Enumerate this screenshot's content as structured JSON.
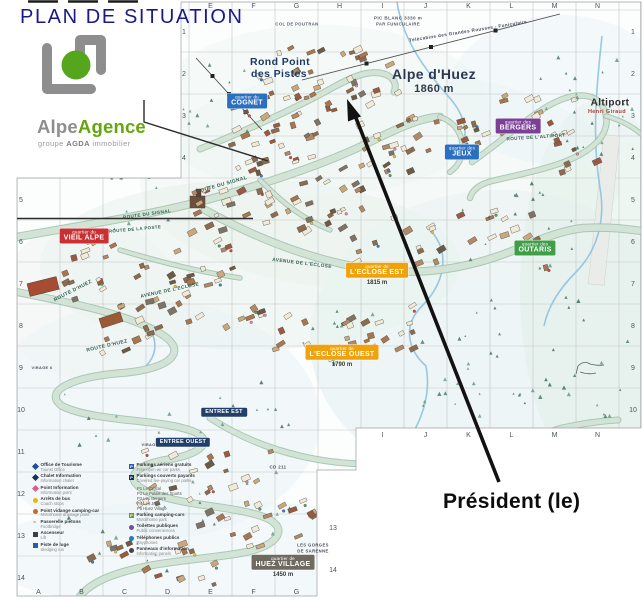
{
  "page": {
    "title": "PLAN DE SITUATION"
  },
  "logo": {
    "name_gray": "Alpe",
    "name_green": "Agence",
    "tagline": {
      "prefix": "groupe",
      "brand": "AGDA",
      "suffix": "immobilier"
    },
    "colors": {
      "gray": "#8e8e8e",
      "green": "#63a70f",
      "circle_green": "#55a51d"
    }
  },
  "annotation": {
    "president_label": "Président (le)"
  },
  "grid": {
    "top_letters": [
      "E",
      "F",
      "G",
      "H",
      "I",
      "J",
      "K",
      "L",
      "M",
      "N"
    ],
    "bottom_letters": [
      "A",
      "B",
      "C",
      "D",
      "E",
      "F",
      "G"
    ],
    "bottom_right_letters": [
      "I",
      "J",
      "K",
      "L",
      "M",
      "N"
    ],
    "left_numbers": [
      "1",
      "2",
      "3",
      "4",
      "5",
      "6",
      "7",
      "8",
      "9",
      "10",
      "11",
      "12",
      "13",
      "14"
    ],
    "right_numbers": [
      "1",
      "2",
      "3",
      "4",
      "5",
      "6",
      "7",
      "8",
      "9",
      "10"
    ],
    "inner_right_numbers": [
      "13",
      "14"
    ]
  },
  "districts": [
    {
      "key": "cognet",
      "prefix": "quartier du",
      "name": "COGNET",
      "x": 247,
      "y": 101,
      "bg": "#2a6fc0"
    },
    {
      "key": "jeux",
      "prefix": "quartier des",
      "name": "JEUX",
      "x": 462,
      "y": 152,
      "bg": "#2a6fc0"
    },
    {
      "key": "bergers",
      "prefix": "quartier des",
      "name": "BERGERS",
      "x": 518,
      "y": 126,
      "bg": "#7b3f97"
    },
    {
      "key": "vieil-alpe",
      "prefix": "quartier du",
      "name": "VIEIL ALPE",
      "x": 84,
      "y": 236,
      "bg": "#c92f33"
    },
    {
      "key": "outaris",
      "prefix": "quartier des",
      "name": "OUTARIS",
      "x": 535,
      "y": 248,
      "bg": "#3f9f47"
    },
    {
      "key": "eclose-est",
      "prefix": "quartier de",
      "name": "L'ECLOSE EST",
      "x": 377,
      "y": 274,
      "bg": "#efa20c",
      "alt": "1815 m"
    },
    {
      "key": "eclose-ouest",
      "prefix": "quartier de",
      "name": "L'ECLOSE OUEST",
      "x": 342,
      "y": 356,
      "bg": "#efa20c",
      "alt": "1790 m"
    },
    {
      "key": "huez-village",
      "prefix": "quartier de",
      "name": "HUEZ VILLAGE",
      "x": 283,
      "y": 566,
      "bg": "#6e6a60",
      "alt": "1450 m"
    },
    {
      "key": "entree-est",
      "prefix": null,
      "name": "ENTREE EST",
      "x": 224,
      "y": 412,
      "bg": "#223e6b"
    },
    {
      "key": "entree-ouest",
      "prefix": null,
      "name": "ENTREE OUEST",
      "x": 183,
      "y": 442,
      "bg": "#223e6b"
    }
  ],
  "map_labels": [
    {
      "name": "label-rond-point-1",
      "text": "Rond Point",
      "x": 280,
      "y": 62,
      "size": 10.5,
      "color": "#1d3a63",
      "bold": true
    },
    {
      "name": "label-rond-point-2",
      "text": "des Pistes",
      "x": 279,
      "y": 74,
      "size": 10.5,
      "color": "#1d3a63",
      "bold": true
    },
    {
      "name": "label-resort-name",
      "text": "Alpe d'Huez",
      "x": 434,
      "y": 74,
      "size": 14,
      "color": "#2b3950",
      "bold": true
    },
    {
      "name": "label-resort-alt",
      "text": "1860 m",
      "x": 434,
      "y": 89,
      "size": 11,
      "color": "#2b3950",
      "bold": true
    },
    {
      "name": "label-altiport",
      "text": "Altiport",
      "x": 610,
      "y": 103,
      "size": 10,
      "color": "#2e2e2e",
      "bold": true
    },
    {
      "name": "label-altiport-sub",
      "text": "Henri Giraud",
      "x": 607,
      "y": 112,
      "size": 5.5,
      "color": "#a8402e"
    },
    {
      "name": "label-pic-blanc",
      "text": "PIC BLANC 3330 m",
      "x": 398,
      "y": 18,
      "size": 4.6,
      "color": "#5a5a66"
    },
    {
      "name": "label-funiculaire",
      "text": "PAR FUNICULAIRE",
      "x": 398,
      "y": 24,
      "size": 4.2,
      "color": "#5a5a66"
    },
    {
      "name": "label-col-poutran",
      "text": "COL DE POUTRAN",
      "x": 297,
      "y": 24,
      "size": 4.2,
      "color": "#5a5a66"
    },
    {
      "name": "label-telecabine",
      "text": "Télécabine des Grandes Rousses - Funiculaire",
      "x": 468,
      "y": 31,
      "size": 4.6,
      "color": "#4a4a58",
      "rot": -9
    },
    {
      "name": "route-signal-1",
      "text": "ROUTE DU SIGNAL",
      "x": 222,
      "y": 185,
      "size": 5,
      "color": "#33604f",
      "rot": -16
    },
    {
      "name": "route-signal-2",
      "text": "ROUTE DU SIGNAL",
      "x": 147,
      "y": 214,
      "size": 4.6,
      "color": "#33604f",
      "rot": -8
    },
    {
      "name": "route-poste",
      "text": "ROUTE DE LA POSTE",
      "x": 135,
      "y": 229,
      "size": 4.4,
      "color": "#33604f",
      "rot": -5
    },
    {
      "name": "route-huez-1",
      "text": "ROUTE D'HUEZ",
      "x": 73,
      "y": 291,
      "size": 5,
      "color": "#33604f",
      "rot": -27
    },
    {
      "name": "route-huez-2",
      "text": "ROUTE D'HUEZ",
      "x": 107,
      "y": 346,
      "size": 5,
      "color": "#33604f",
      "rot": -13
    },
    {
      "name": "avenue-eclose-1",
      "text": "AVENUE DE L'ECLOSE",
      "x": 170,
      "y": 291,
      "size": 4.8,
      "color": "#33604f",
      "rot": -12
    },
    {
      "name": "avenue-eclose-2",
      "text": "AVENUE DE L'ECLOSE",
      "x": 302,
      "y": 264,
      "size": 4.8,
      "color": "#33604f",
      "rot": 7
    },
    {
      "name": "route-altiport",
      "text": "ROUTE DE L'ALTIPORT",
      "x": 536,
      "y": 137,
      "size": 4.6,
      "color": "#33604f",
      "rot": -4
    },
    {
      "name": "label-cd211",
      "text": "CD 211",
      "x": 278,
      "y": 467,
      "size": 4.4,
      "color": "#4a4a58"
    },
    {
      "name": "label-virage-1",
      "text": "VIRAGE 1",
      "x": 152,
      "y": 445,
      "size": 3.8,
      "color": "#4a4a58"
    },
    {
      "name": "label-virage-6",
      "text": "VIRAGE 6",
      "x": 42,
      "y": 368,
      "size": 3.8,
      "color": "#4a4a58"
    },
    {
      "name": "label-gorges-1",
      "text": "LES GORGES",
      "x": 313,
      "y": 545,
      "size": 4.2,
      "color": "#4a4a58"
    },
    {
      "name": "label-gorges-2",
      "text": "DE SARENNE",
      "x": 313,
      "y": 551,
      "size": 4.2,
      "color": "#4a4a58"
    }
  ],
  "legend": {
    "left": [
      {
        "icon": "diamond",
        "color": "#1f4e9c",
        "fr": "Office de Tourisme",
        "en": "Tourist Office"
      },
      {
        "icon": "diamond",
        "color": "#16325c",
        "fr": "Chalet Information",
        "en": "Information chalet"
      },
      {
        "icon": "diamond",
        "color": "#d4618c",
        "fr": "Point Information",
        "en": "Information point"
      },
      {
        "icon": "circle",
        "color": "#e8b80e",
        "fr": "Arrêts de bus",
        "en": "Coach stops"
      },
      {
        "icon": "circle",
        "color": "#c96a2a",
        "fr": "Point vidange camping-car",
        "en": "Motorhome drainage point"
      },
      {
        "icon": "wave",
        "color": "#8a8a8a",
        "fr": "Passerelle piétons",
        "en": "Footbridge"
      },
      {
        "icon": "square",
        "color": "#3f3f3f",
        "fr": "Ascenseur",
        "en": "Lift"
      },
      {
        "icon": "square",
        "color": "#2a5caa",
        "fr": "Piste de luge",
        "en": "Sledging run"
      }
    ],
    "right": [
      {
        "icon": "parking",
        "color": "#2a5caa",
        "fr": "Parkings aériens gratuits",
        "en": "Free open-air car parks"
      },
      {
        "icon": "parking",
        "color": "#16325c",
        "fr": "Parkings couverts payants",
        "en": "Covered fee-paying car parks",
        "sub": [
          "P1 Le Cristal",
          "P2 Le Palais des Sports",
          "P3 Les Bergers",
          "P4 Les Jeux",
          "P5 Huez Village"
        ]
      },
      {
        "icon": "parking",
        "color": "#6a9a3a",
        "fr": "Parking camping-cars",
        "en": "Motorhome park"
      },
      {
        "icon": "circle",
        "color": "#7a4a9a",
        "fr": "Toilettes publiques",
        "en": "Public conveniences"
      },
      {
        "icon": "circle",
        "color": "#2a7ab8",
        "fr": "Téléphones publics",
        "en": "Payphones"
      },
      {
        "icon": "circle",
        "color": "#444444",
        "fr": "Panneaux d'information",
        "en": "Information panels"
      }
    ]
  },
  "colors": {
    "title_navy": "#191989",
    "arrow_black": "#121212"
  }
}
